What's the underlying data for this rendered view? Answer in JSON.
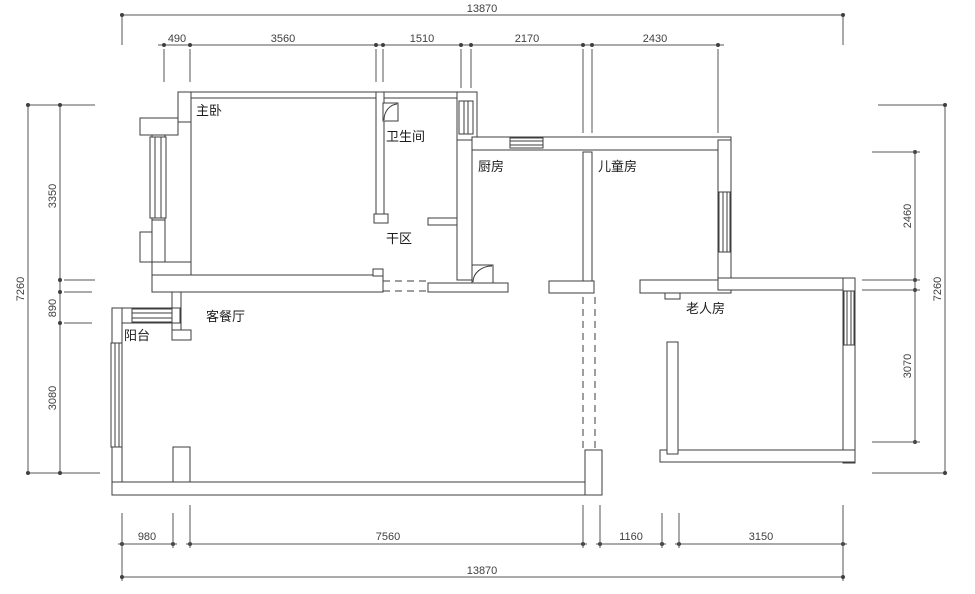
{
  "rooms": {
    "master_bedroom": "主卧",
    "bathroom": "卫生间",
    "dry_area": "干区",
    "kitchen": "厨房",
    "children_room": "儿童房",
    "living_dining": "客餐厅",
    "balcony": "阳台",
    "elderly_room": "老人房"
  },
  "dimensions": {
    "top": {
      "total": "13870",
      "segments": [
        "490",
        "3560",
        "1510",
        "2170",
        "2430"
      ]
    },
    "bottom": {
      "total": "13870",
      "segments": [
        "980",
        "7560",
        "1160",
        "3150"
      ]
    },
    "left": {
      "total": "7260",
      "segments": [
        "3350",
        "890",
        "3080"
      ]
    },
    "right": {
      "total": "7260",
      "segments": [
        "2460",
        "3070"
      ]
    }
  },
  "colors": {
    "wall_line": "#3d3d3d",
    "dim_line": "#555555",
    "text": "#1c1c1c",
    "background": "#ffffff"
  }
}
